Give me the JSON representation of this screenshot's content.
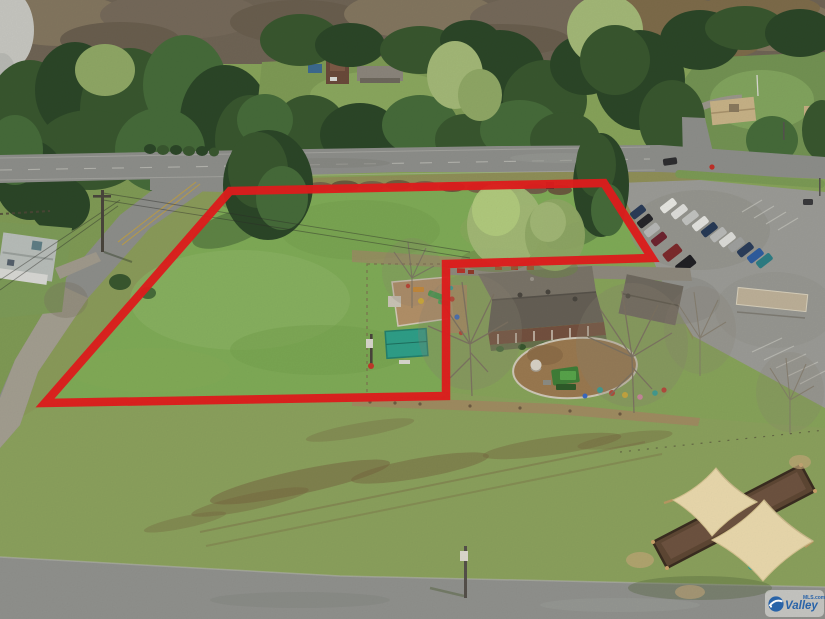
{
  "meta": {
    "type": "aerial-drone-photograph",
    "subject": "Vacant land parcel outlined in red beside a childcare building with playgrounds, a parking lot with cars, roads, forest and shade-sail play pen"
  },
  "watermark": {
    "brand": "Valley",
    "suffix": "MLS.com"
  },
  "annotation": {
    "boundary_color": "#e21d1d",
    "boundary_stroke_px": 8.5,
    "boundary_vertices": [
      [
        230,
        191
      ],
      [
        604,
        183
      ],
      [
        652,
        258
      ],
      [
        446,
        264
      ],
      [
        446,
        396
      ],
      [
        45,
        403
      ]
    ]
  },
  "palette": {
    "parcel_grass": "#7fab57",
    "field_grass": "#8aa25c",
    "rough_grass": "#8f8f58",
    "forest_green": "#39572f",
    "bare_forest": "#6f6455",
    "asphalt": "#8d8e8a",
    "parking": "#9b9b96",
    "roof": "#6e685e",
    "brick": "#74513f",
    "mulch": "#a9895f",
    "sail_cream": "#ead9ad",
    "canopy_teal": "#2f9f88",
    "watermark_blue": "#2a66ad"
  },
  "scene_objects": [
    "forest",
    "main-road",
    "side-road",
    "north-side-road",
    "left-house",
    "parcel-field",
    "red-boundary-outline",
    "daycare-building",
    "west-playground",
    "east-playground",
    "parking-lot",
    "parked-cars",
    "power-poles",
    "shade-sail-pen",
    "bottom-road",
    "mls-watermark"
  ]
}
